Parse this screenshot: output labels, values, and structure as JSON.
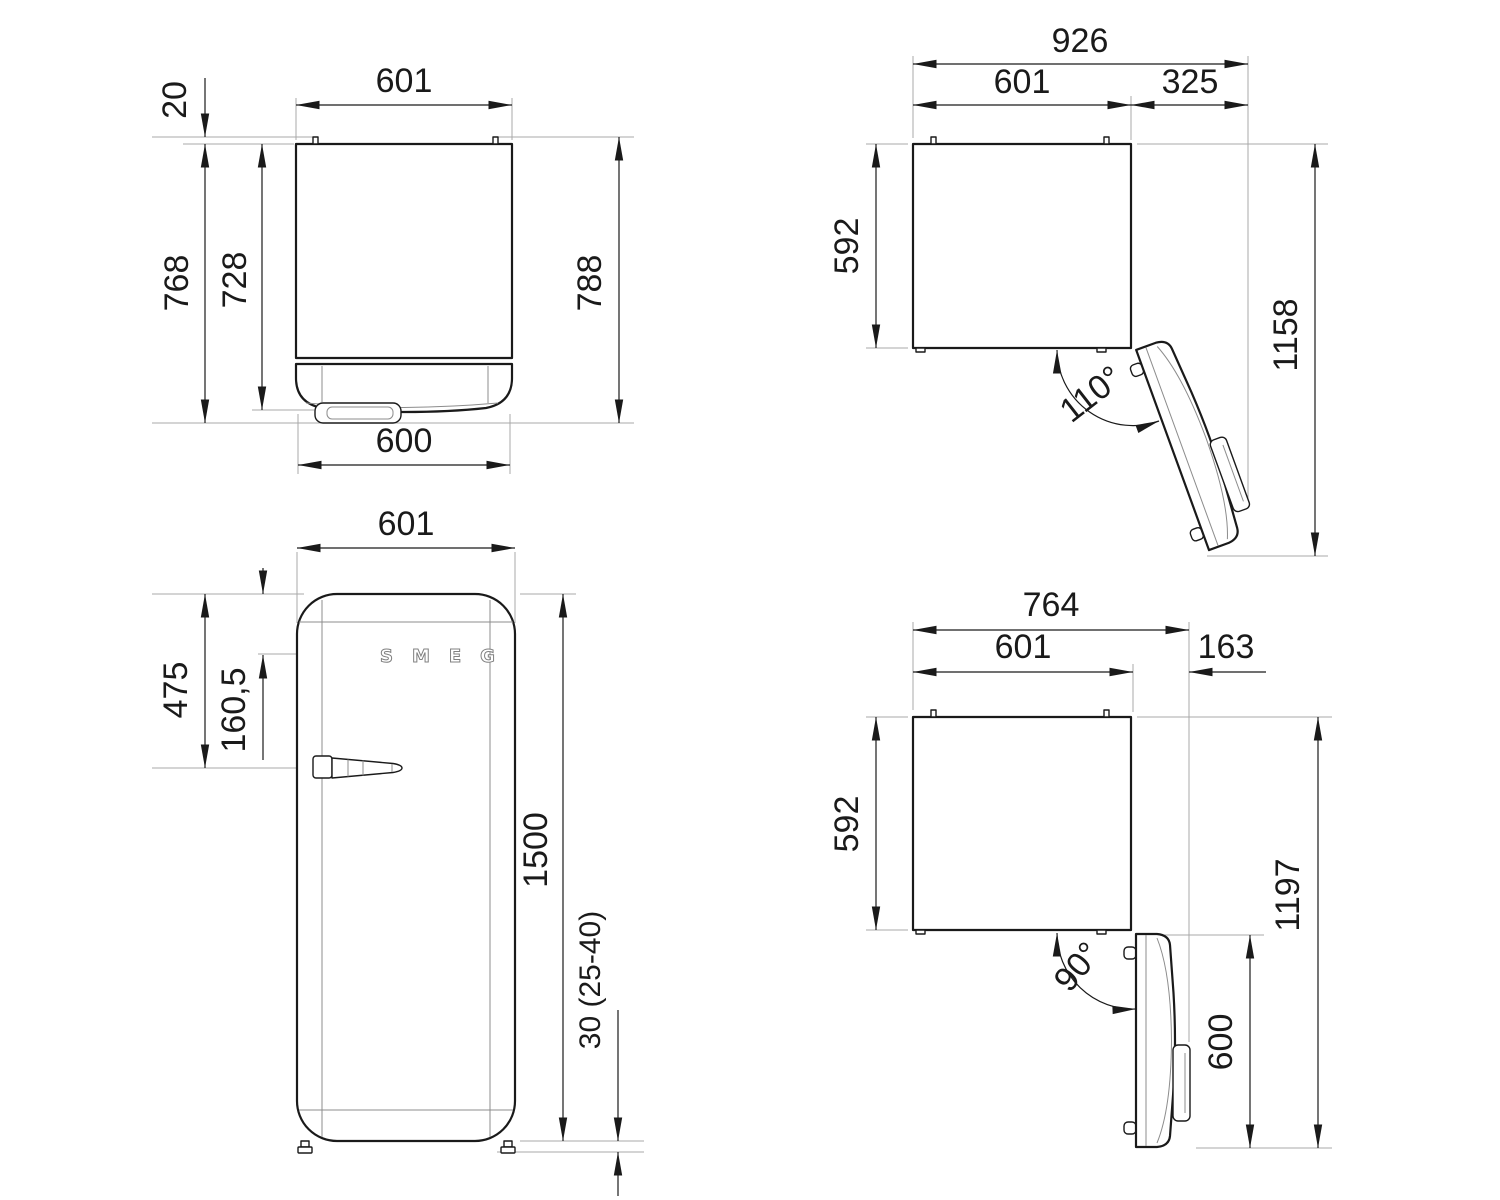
{
  "colors": {
    "line": "#1a1a1a",
    "extension_line": "#a9a9a9",
    "background": "#ffffff",
    "logo_gray": "#808080"
  },
  "logo": {
    "text": "SMEG"
  },
  "views": {
    "top_closed": {
      "width_top": "601",
      "pin_gap": "20",
      "depth_body": "728",
      "depth_with_handle": "768",
      "depth_overall": "788",
      "door_width": "600"
    },
    "top_open_110": {
      "overall_width": "926",
      "body_width": "601",
      "door_swing": "325",
      "body_depth": "592",
      "overall_depth": "1158",
      "door_angle": "110°"
    },
    "front": {
      "width": "601",
      "handle_offset": "475",
      "logo_offset": "160,5",
      "height": "1500",
      "plinth_clearance": "30 (25-40)"
    },
    "top_open_90": {
      "overall_width": "764",
      "body_width": "601",
      "door_swing": "163",
      "body_depth": "592",
      "overall_depth": "1197",
      "door_depth_open": "600",
      "door_angle": "90°"
    }
  }
}
